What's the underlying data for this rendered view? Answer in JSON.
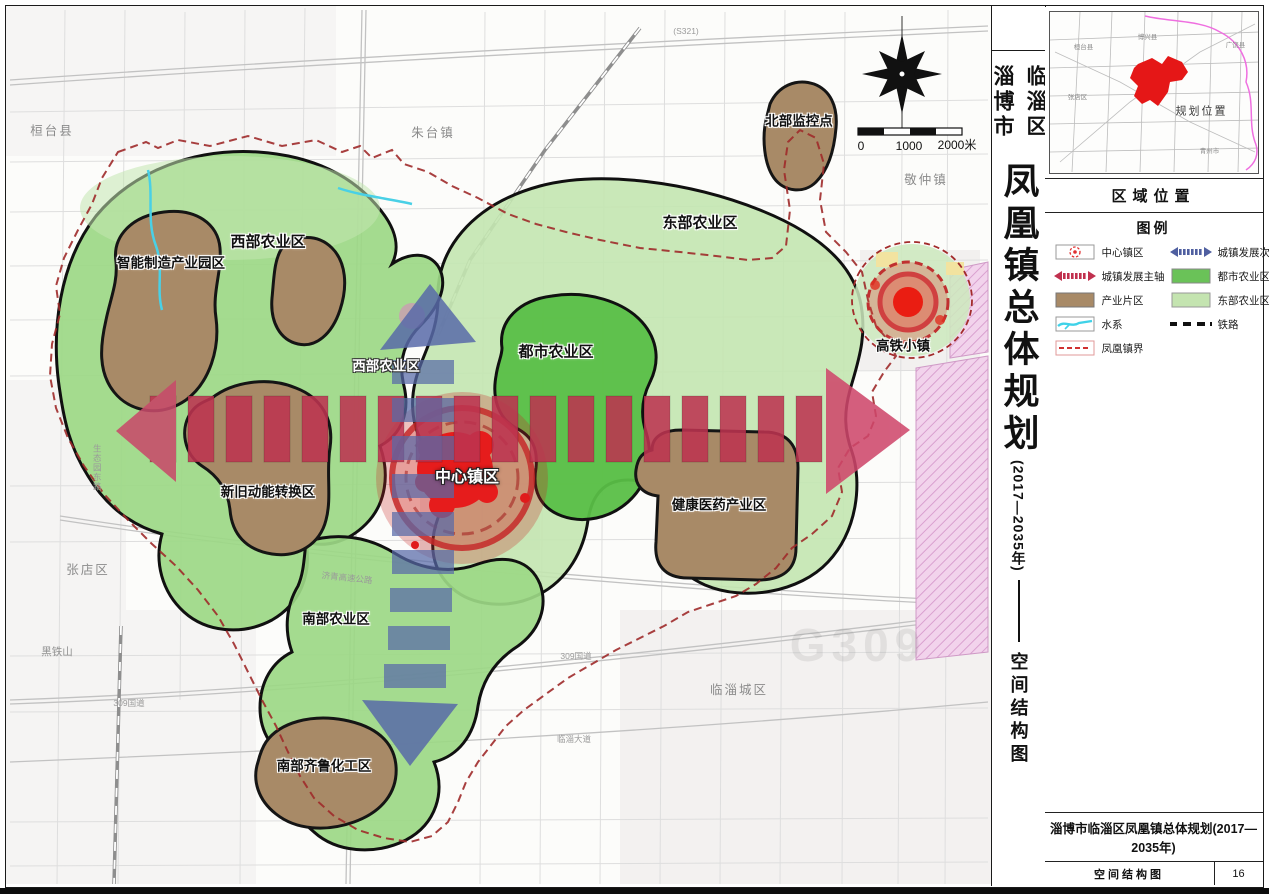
{
  "title_strip": {
    "district": "临淄区",
    "city": "淄博市",
    "main_title": "凤凰镇总体规划",
    "period": "(2017—2035年)",
    "doc_type": "空间结构图"
  },
  "right_panel": {
    "locator_header": "区域位置",
    "locator_labels": {
      "nw": "桓台县",
      "n": "博兴县",
      "ne": "广饶县",
      "w": "张店区",
      "marker": "规划位置",
      "se": "青州市"
    },
    "legend": {
      "title": "图例",
      "left": [
        {
          "label": "中心镇区",
          "symbol": "center-town-icon"
        },
        {
          "label": "城镇发展主轴",
          "symbol": "main-axis-icon"
        },
        {
          "label": "产业片区",
          "symbol": "industry-swatch"
        },
        {
          "label": "水系",
          "symbol": "water-icon"
        },
        {
          "label": "凤凰镇界",
          "symbol": "town-boundary-icon"
        }
      ],
      "right": [
        {
          "label": "城镇发展次轴",
          "symbol": "secondary-axis-icon"
        },
        {
          "label": "都市农业区",
          "symbol": "metro-agri-swatch"
        },
        {
          "label": "东部农业区",
          "symbol": "east-agri-swatch"
        },
        {
          "label": "铁路",
          "symbol": "railway-icon"
        }
      ]
    },
    "title_block": {
      "project": "淄博市临淄区凤凰镇总体规划(2017—2035年)",
      "drawing": "空间结构图",
      "page": "16"
    }
  },
  "map": {
    "labels": [
      {
        "text": "桓台县"
      },
      {
        "text": "朱台镇"
      },
      {
        "text": "北部监控点"
      },
      {
        "text": "东部农业区"
      },
      {
        "text": "敬仲镇"
      },
      {
        "text": "西部农业区"
      },
      {
        "text": "智能制造产业园区"
      },
      {
        "text": "西部农业区"
      },
      {
        "text": "都市农业区"
      },
      {
        "text": "高铁小镇"
      },
      {
        "text": "中心镇区"
      },
      {
        "text": "新旧动能转换区"
      },
      {
        "text": "健康医药产业区"
      },
      {
        "text": "张店区"
      },
      {
        "text": "南部农业区"
      },
      {
        "text": "临淄城区"
      },
      {
        "text": "南部齐鲁化工区"
      },
      {
        "text": "黑铁山"
      },
      {
        "text": "(S321)"
      },
      {
        "text": "309国道"
      },
      {
        "text": "临淄大道"
      },
      {
        "text": "309国道"
      },
      {
        "text": "济青高速公路"
      },
      {
        "text": "生态园东路"
      },
      {
        "text": "G309"
      }
    ],
    "scale": {
      "zero": "0",
      "mid": "1000",
      "end": "2000米"
    }
  },
  "colors": {
    "metro_green": "#5abf47",
    "east_green": "#c3e5b0",
    "west_green": "#9cd886",
    "industry_brown": "#a88a67",
    "axis_red": "#c23a58",
    "axis_blue": "#5a6aa8",
    "center_red": "#e61c1c",
    "boundary_red": "#9e2a2a",
    "water_cyan": "#49d0e6",
    "pink_zone": "#f2d3ec"
  }
}
